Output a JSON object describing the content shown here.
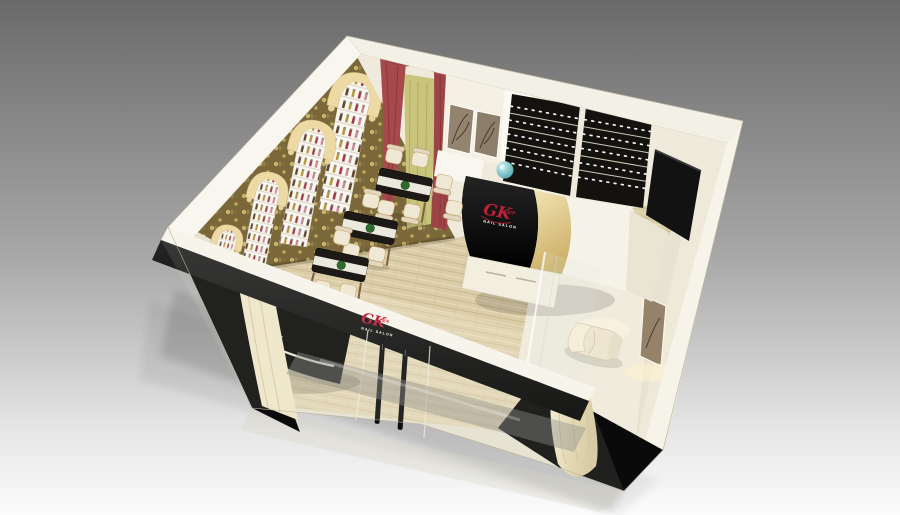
{
  "scene": {
    "title": "GK Nail Salon — 3D interior render",
    "view": "isometric cutaway (dollhouse) view from above",
    "background": "gray studio gradient"
  },
  "brand": {
    "initials": "GK",
    "cjk": "美甲",
    "wordmark": "NAIL SALON",
    "accent": "#c2203a"
  },
  "palette": {
    "bg_top": "#6a6a6a",
    "bg_mid": "#a8a8a8",
    "bg_bottom": "#fcfcfc",
    "ivory": "#e7e2d1",
    "wall_white": "#f7f4ec",
    "black": "#0b0b0b",
    "wood_floor": "#dbcda8",
    "wallpaper_gold": "#7a683a",
    "wallpaper_motif": "#c9b46c",
    "arch_cream": "#ecd9a4",
    "shelf_white": "#f9f7f0",
    "curtain_red": "#a64a4e",
    "sheer_green": "#c9c47c",
    "drape_cream": "#f0e7ca",
    "counter_gold": "#cdb06a",
    "counter_white": "#f5f2e7",
    "chair_cream": "#efe8d4",
    "chair_wood": "#b08d5f",
    "table_black": "#1c1916",
    "plant_green": "#2f6b2f",
    "teal_lamp": "#3e98a6",
    "glass_reflection": "#8f8f8b"
  },
  "inventory": {
    "manicure_tables": 4,
    "manicure_chairs": 14,
    "pedicure_chairs": 2,
    "polish_display_arches": 4,
    "wall_display_racks": 2,
    "door_handles": 2,
    "reception_desk": "black curved desk with illuminated trim",
    "feature_wall": "gold damask wallpaper with arched polish niches",
    "window_treatment": "red swag curtains with green sheer",
    "wall_art": "tree-branch canvas panels"
  }
}
